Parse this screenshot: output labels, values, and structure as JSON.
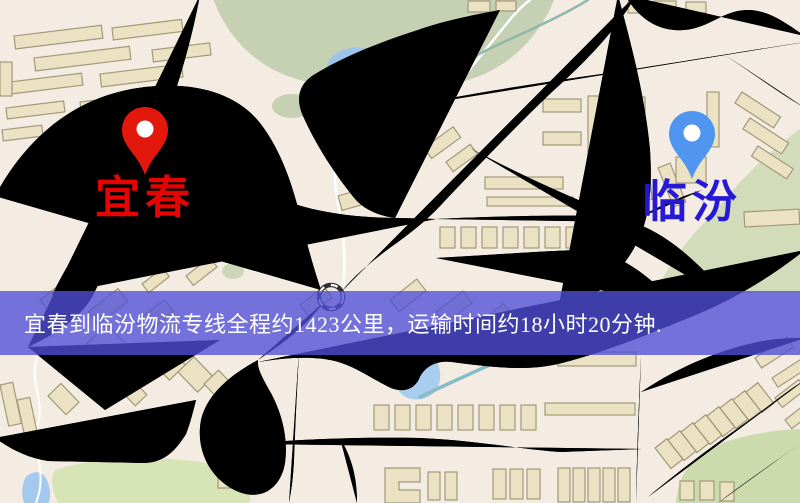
{
  "banner": {
    "text": "宜春到临汾物流专线全程约1423公里，运输时间约18小时20分钟.",
    "bg": "rgba(80,78,216,0.78)",
    "text_color": "#ffffff"
  },
  "markers": {
    "origin": {
      "label": "宜春",
      "pin_color": "#e2180c",
      "pin_hole_color": "#ffffff",
      "label_color": "#e60303",
      "x": 145,
      "y": 178
    },
    "destination": {
      "label": "临汾",
      "pin_color": "#5095f0",
      "pin_hole_color": "#ffffff",
      "label_color": "#2518d6",
      "x": 692,
      "y": 182
    }
  },
  "colors": {
    "map_background": "#f4ece2",
    "road_fill": "#f8d47c",
    "road_casing": "#e9b55c",
    "railway": "#2e2e2e",
    "building": "#ebe2c4",
    "green_area": "#c6d0b2",
    "park": "#d6e4b6",
    "water": "#a3c9ee"
  }
}
